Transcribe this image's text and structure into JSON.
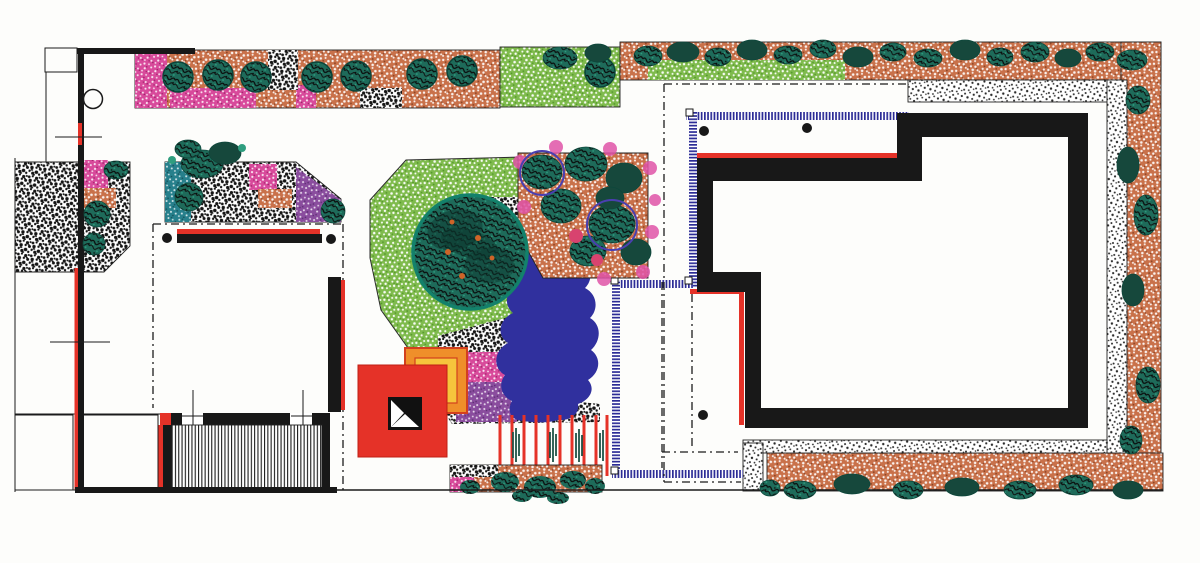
{
  "palette": {
    "paper": "#fdfdfb",
    "ink": "#1b1b1b",
    "wall": "#181818",
    "red": "#e53228",
    "red_deep": "#c02015",
    "orange_square": "#ef8f2a",
    "yellow_square": "#f6c53c",
    "terracotta": "#c9714a",
    "terracotta_dark": "#7e3a1d",
    "lawn_green": "#7fbb4d",
    "green_dark": "#4c8f26",
    "magenta": "#d84a9b",
    "magenta_deep": "#9c2368",
    "purple": "#8a4d9e",
    "purple_deep": "#5d2f73",
    "teal_bed": "#27808c",
    "teal_bed_deep": "#145058",
    "bush": "#1e6b5a",
    "bush_dark": "#16483c",
    "bush_light": "#2f9e7f",
    "tree_ring": "#13816b",
    "pond": "#30309e",
    "navy": "#2c2c96",
    "flower_pink": "#e054a8",
    "flower_red": "#d8436f",
    "sedge": "#1d5247",
    "stipple_black": "#141414"
  }
}
